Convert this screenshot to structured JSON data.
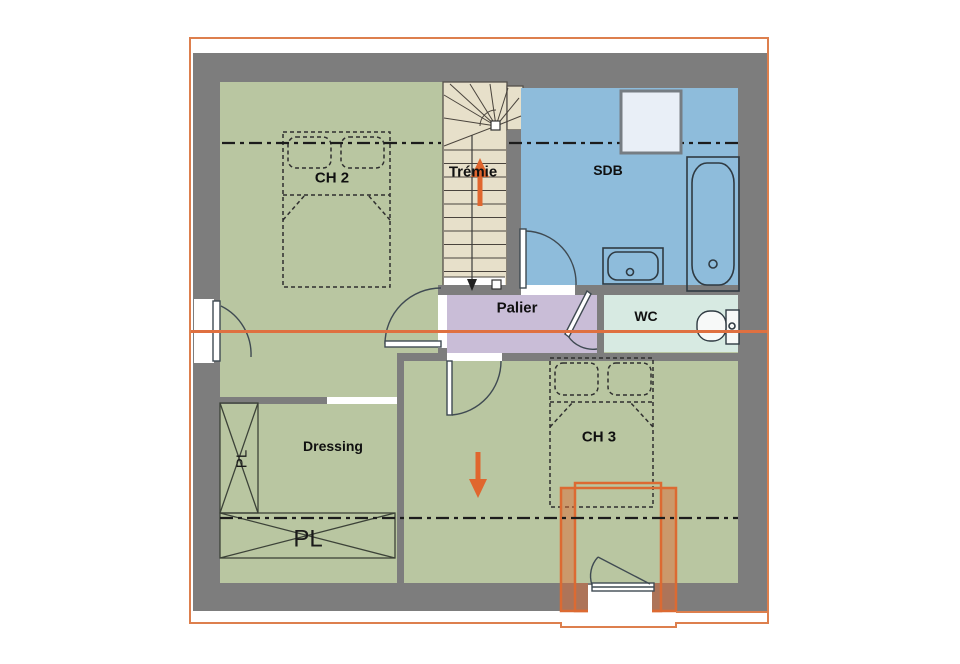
{
  "floor_plan": {
    "rooms": {
      "ch2": "CH 2",
      "tremie": "Trémie",
      "sdb": "SDB",
      "palier": "Palier",
      "wc": "WC",
      "dressing": "Dressing",
      "ch3": "CH 3",
      "closet_horizontal": "PL",
      "closet_vertical": "PL"
    },
    "fixtures": [
      "staircase-with-winder",
      "double-bed-ch2",
      "double-bed-ch3",
      "roof-window",
      "bathtub",
      "washbasin",
      "toilet",
      "window-left-wall",
      "dormer-window",
      "door-ch2",
      "door-sdb",
      "door-wc",
      "door-ch3",
      "up-arrow",
      "down-arrow"
    ],
    "colors": {
      "wall_gray": "#7d7d7d",
      "room_green": "#b9c6a1",
      "bathroom_blue": "#8ebcdb",
      "wc_mint": "#d7eae2",
      "landing_lavender": "#c9bdd7",
      "stair_beige": "#e7e0ca",
      "accent_orange": "#e0662e",
      "border_orange": "#dd7f4d",
      "velux_fill": "#e9eff7"
    }
  }
}
